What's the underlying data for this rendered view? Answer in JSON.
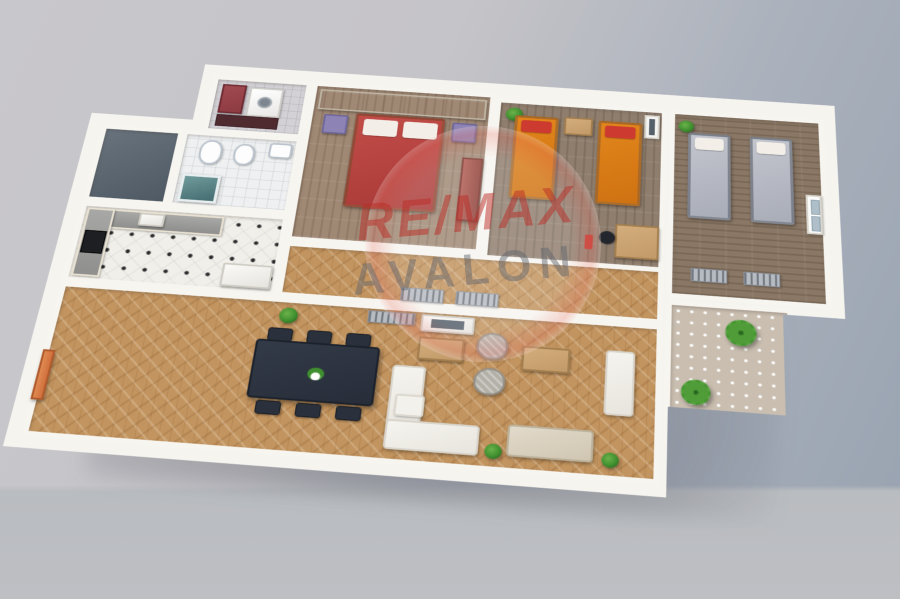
{
  "scene": {
    "type": "3d-floor-plan-render",
    "description": "Isometric 3D rendering of a three-bedroom apartment floor plan on a gray studio backdrop"
  },
  "watermark": {
    "line1": "RE/MAX",
    "line2": "AVALON"
  },
  "colors": {
    "wall": "#f6f4ef",
    "background_left": "#c8c7cb",
    "background_right": "#98a2b0",
    "living_floor": "#c2945f",
    "master_floor": "#9f8874",
    "kids_floor": "#8f7e6e",
    "guest_floor": "#8a7765",
    "kitchen_floor": "#f1efe9",
    "bath_floor": "#eef0f1",
    "balcony_floor": "#c9beb0",
    "master_bed": "#c24d48",
    "kids_bed": "#e2861c",
    "guest_bed": "#a9adb8",
    "nightstand": "#8d84b5",
    "sofa_beige": "#d0c6b2",
    "armchair": "#b3b0a8",
    "dining_table": "#272e3a",
    "wood_furniture": "#c29a6a",
    "entry_door": "#d2713d",
    "plant": "#3f8f2f",
    "laundry_cabinet": "#8e3a42",
    "watermark_red": "#ba2c26",
    "watermark_gray": "#60646c"
  },
  "rooms": [
    {
      "name": "laundry",
      "furniture": [
        "red-cabinet",
        "washing-machine",
        "dark-counter"
      ]
    },
    {
      "name": "bathroom",
      "furniture": [
        "toilet",
        "bidet",
        "sink",
        "shower"
      ]
    },
    {
      "name": "storage",
      "furniture": []
    },
    {
      "name": "master-bedroom",
      "furniture": [
        "wardrobe",
        "double-bed",
        "nightstand-left",
        "nightstand-right",
        "red-dresser"
      ]
    },
    {
      "name": "kids-bedroom",
      "furniture": [
        "single-bed-1",
        "single-bed-2",
        "nightstand",
        "desk",
        "desk-chair",
        "plant",
        "tv"
      ]
    },
    {
      "name": "guest-bedroom",
      "furniture": [
        "single-bed-1",
        "single-bed-2",
        "radiator-1",
        "radiator-2",
        "window",
        "plant"
      ]
    },
    {
      "name": "kitchen",
      "furniture": [
        "counter-top",
        "counter-left",
        "cooktop",
        "sink",
        "appliance"
      ]
    },
    {
      "name": "hallway",
      "furniture": [
        "radiator-1",
        "radiator-2"
      ]
    },
    {
      "name": "living-dining-room",
      "furniture": [
        "entry-door",
        "tv-sideboard",
        "dining-table",
        "dining-chairs-6",
        "centerpiece-plant",
        "white-corner-sofa",
        "ottoman",
        "coffee-table-1",
        "coffee-table-2",
        "armchair-1",
        "armchair-2",
        "beige-sofa",
        "white-armchair",
        "plants"
      ]
    },
    {
      "name": "balcony",
      "furniture": [
        "palm-plant-1",
        "palm-plant-2"
      ]
    }
  ]
}
